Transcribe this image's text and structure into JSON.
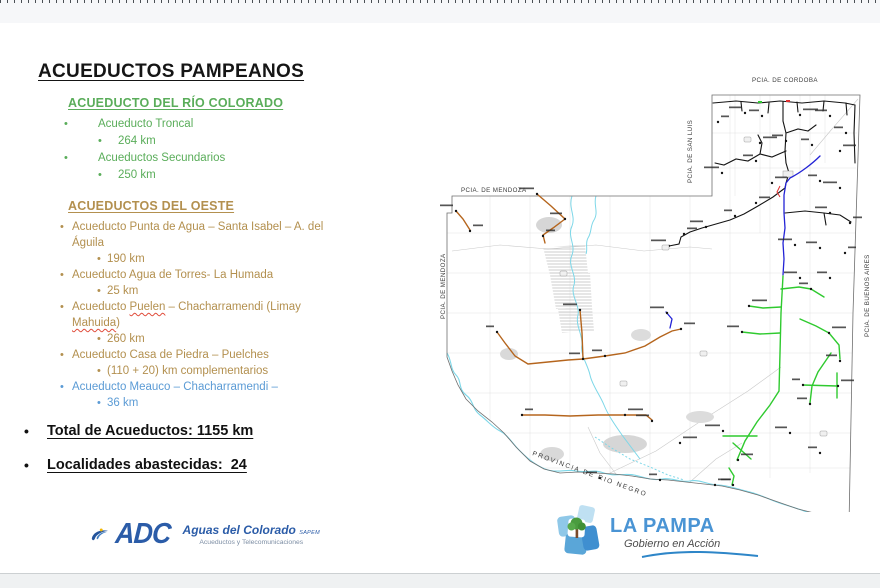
{
  "slide": {
    "title": "ACUEDUCTOS PAMPEANOS",
    "sections": [
      {
        "heading": "ACUEDUCTO DEL RÍO COLORADO",
        "color": "#5aad5a",
        "items": [
          {
            "label": "Acueducto Troncal",
            "km": "264 km"
          },
          {
            "label": "Acueductos Secundarios",
            "km": "250 km"
          }
        ]
      },
      {
        "heading": "ACUEDUCTOS DEL OESTE",
        "color": "#b3904f",
        "items": [
          {
            "label": "Acueducto Punta de Agua – Santa Isabel – A. del Águila",
            "km": "190 km"
          },
          {
            "label": "Acueducto Agua de Torres- La Humada",
            "km": "25 km"
          },
          {
            "label": "Acueducto Puelen – Chacharramendi (Limay Mahuida)",
            "km": "260 km",
            "spell": [
              "Puelen",
              "Mahuida"
            ]
          },
          {
            "label": "Acueducto Casa de Piedra – Puelches",
            "km": "(110 + 20) km complementarios"
          },
          {
            "label": "Acueducto Meauco – Chacharramendi –",
            "km": "36 km",
            "color": "#5b9bd5"
          }
        ]
      }
    ],
    "totals": [
      "Total de Acueductos: 1155 km",
      "Localidades abastecidas:  24"
    ]
  },
  "map": {
    "labels": {
      "cordoba": "PCIA. DE CORDOBA",
      "san_luis": "PCIA. DE SAN LUIS",
      "mendoza_top": "PCIA. DE MENDOZA",
      "mendoza_side": "PCIA. DE MENDOZA",
      "buenos_aires": "PCIA. DE BUENOS AIRES",
      "rio_negro": "PROVINCIA DE RIO NEGRO"
    },
    "colors": {
      "border": "#6f6f6f",
      "network": "#141414",
      "blue": "#2323d6",
      "green": "#2fca2f",
      "brown": "#b5651d",
      "river": "#7dd7e8",
      "alert": "#e03030"
    }
  },
  "footer": {
    "adc": {
      "acronym": "ADC",
      "name": "Aguas del Colorado",
      "suffix": "SAPEM",
      "tagline": "Acueductos y Telecomunicaciones"
    },
    "lapampa": {
      "name": "LA PAMPA",
      "tagline": "Gobierno en Acción"
    }
  }
}
